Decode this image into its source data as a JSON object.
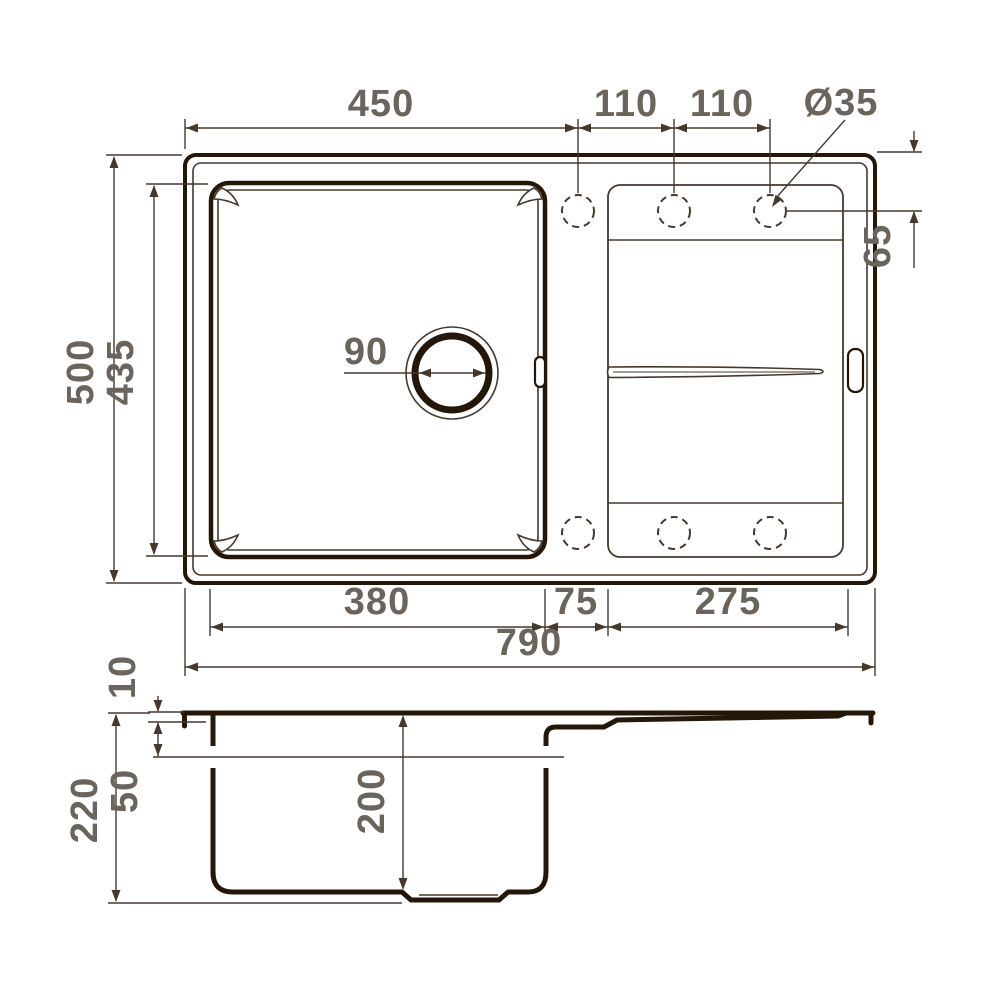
{
  "drawing": {
    "type": "sink-technical-drawing",
    "views": [
      "top-view",
      "section-view"
    ]
  },
  "dims": {
    "top_width": "450",
    "faucet_spacing_a": "110",
    "faucet_spacing_b": "110",
    "faucet_hole_diameter": "Ø35",
    "faucet_offset": "65",
    "overall_depth": "500",
    "bowl_length_plan": "435",
    "drain_diameter": "90",
    "bowl_width": "380",
    "divider_width": "75",
    "drainboard_width": "275",
    "overall_width": "790",
    "rim_height": "10",
    "edge_depth": "50",
    "overall_height": "220",
    "bowl_depth": "200"
  },
  "colors": {
    "outline": "#241608",
    "thin_line": "#46392c",
    "dim_text": "#6a645c",
    "background": "#ffffff"
  }
}
